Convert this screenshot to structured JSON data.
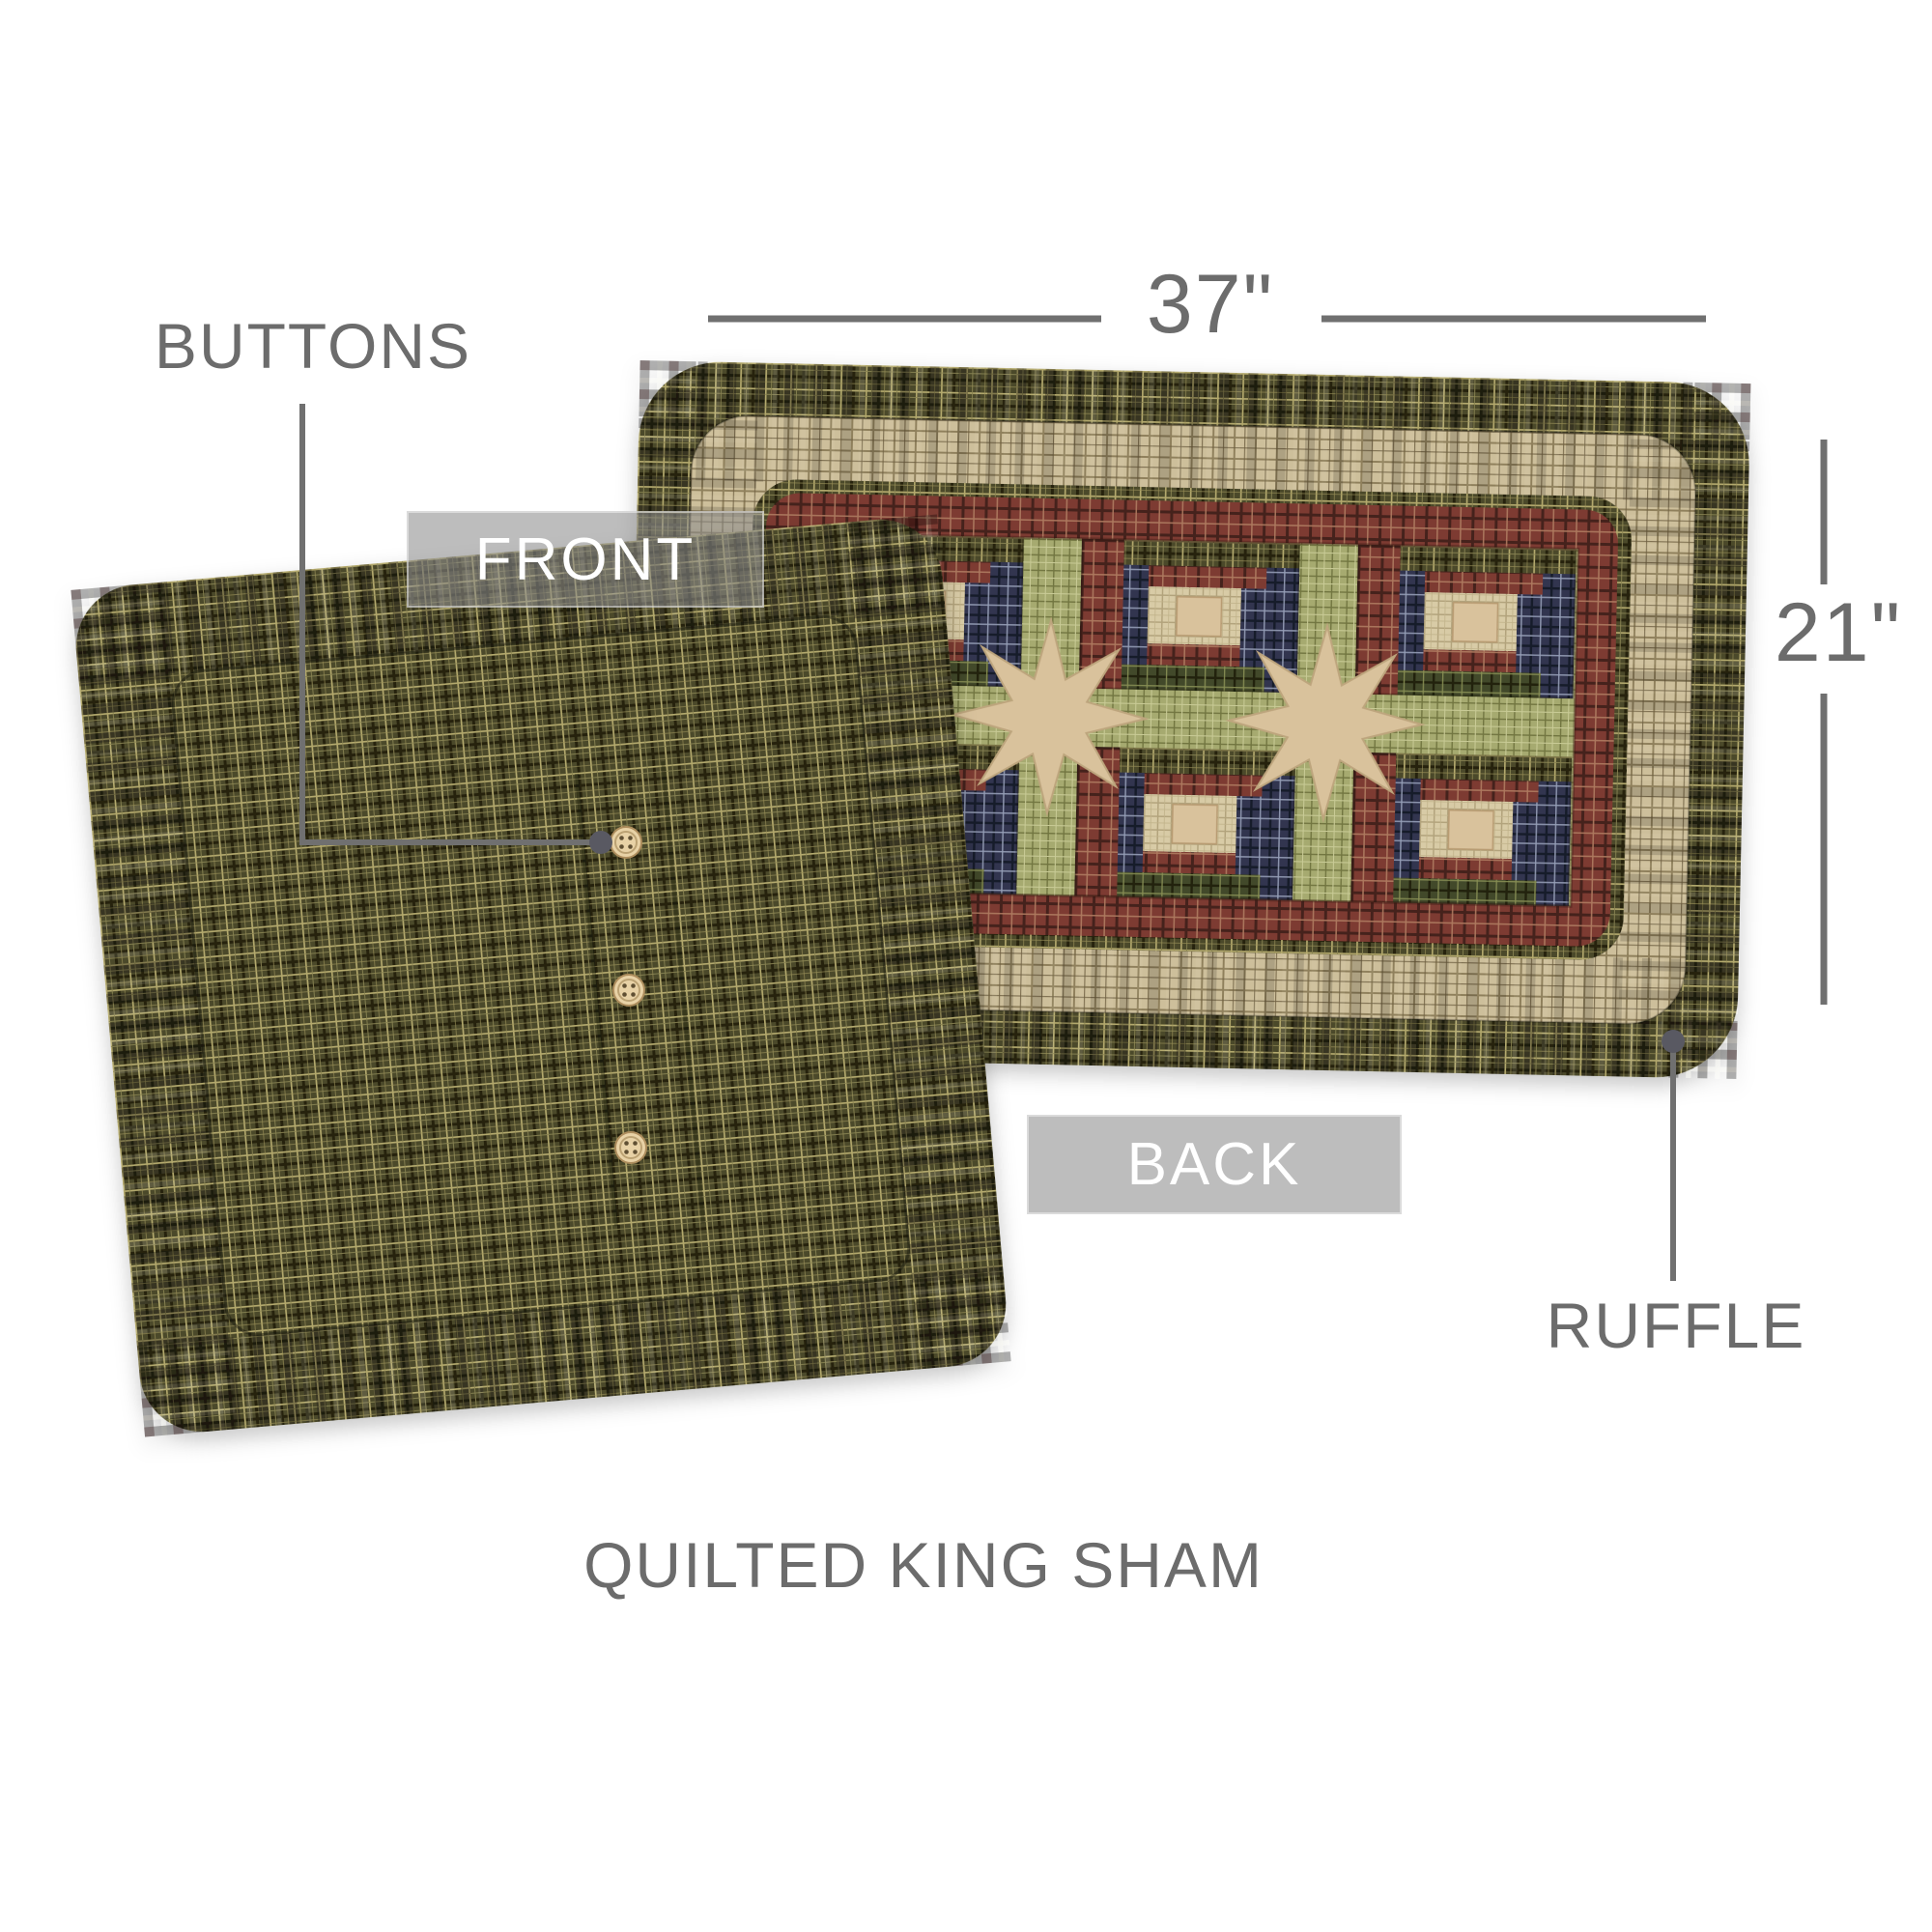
{
  "page": {
    "title": "QUILTED KING SHAM",
    "background_color": "#ffffff"
  },
  "dimensions": {
    "width_label": "37\"",
    "height_label": "21\""
  },
  "callouts": {
    "buttons": "BUTTONS",
    "front": "FRONT",
    "back": "BACK",
    "ruffle": "RUFFLE"
  },
  "product": {
    "button_count": 3,
    "quilt_block_grid": "3x2",
    "star_count": 2,
    "front_view": "log cabin patchwork sham with double ruffle",
    "back_view": "green plaid sham back with button closure and ruffle"
  },
  "colors": {
    "label_text": "#6c6c6c",
    "leader_line": "#707070",
    "leader_dot": "#595962",
    "overlay_box": "rgba(141,141,141,0.58)",
    "overlay_text": "#ffffff",
    "olive_plaid": "#4c492c",
    "tan_plaid": "#cdbf9b",
    "red_plaid": "#7d3a31",
    "navy_plaid": "#303450",
    "green_sashing": "#a6aa70",
    "cream_check": "#d8cba6",
    "star_tan": "#d9c29c",
    "button": "#e8d2a6"
  }
}
